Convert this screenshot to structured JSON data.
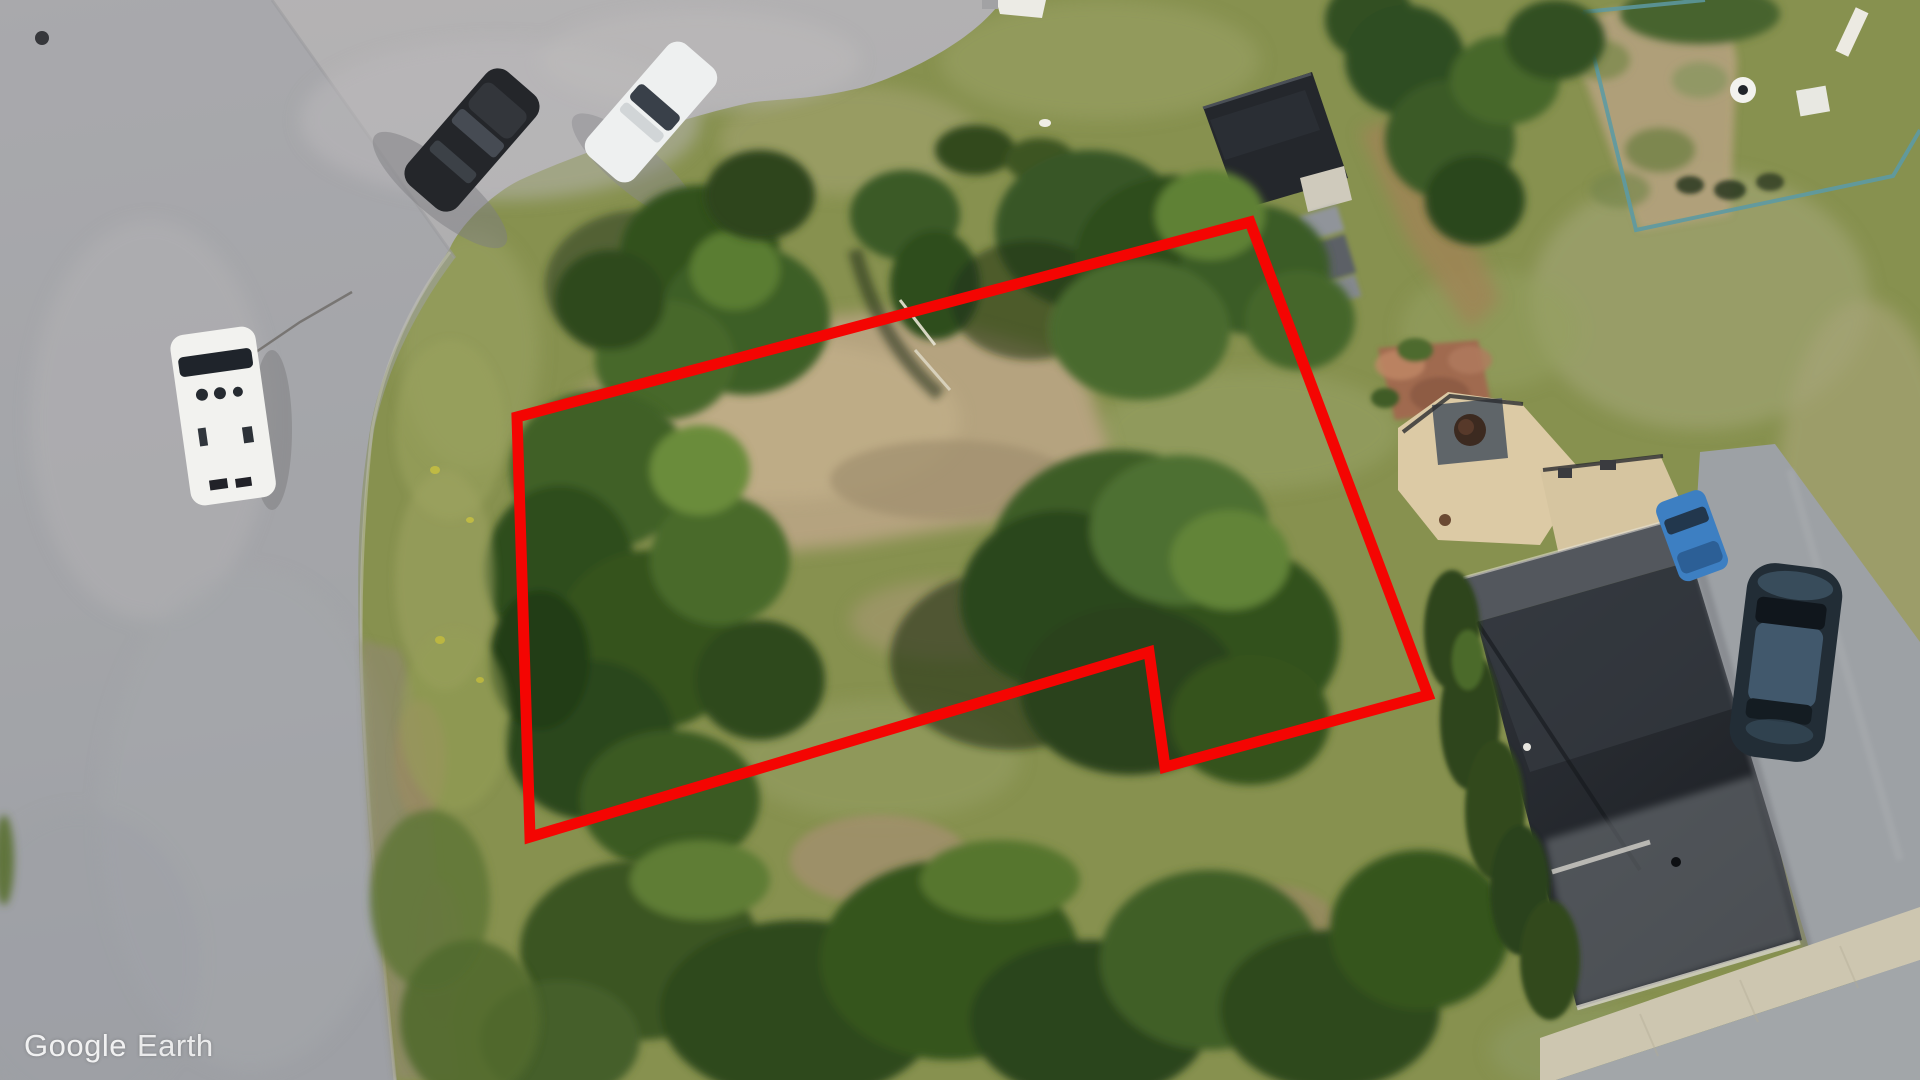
{
  "watermark": {
    "brand": "Google",
    "product": "Earth"
  },
  "annotation": {
    "label": "property-boundary-outline",
    "points": "517,417 1250,222 1428,695 1165,767 1149,652 530,837",
    "color": "#f40502",
    "stroke_width": "11"
  },
  "palette": {
    "grass": "#87914f",
    "dry_grass": "#a3a172",
    "road": "#a9abad",
    "parking_lot": "#b3b1b2",
    "dirt": "#b5a37f",
    "tree_dark": "#2f4a1d",
    "roof_dark": "#24272c",
    "deck_tan": "#dccaa5",
    "fence_teal": "#5d9aa3",
    "sidewalk": "#cdc6b0",
    "driveway": "#9da1a5",
    "gravel_shoulder": "#8e8a68"
  },
  "scene": {
    "view": "satellite-aerial",
    "vehicles": [
      "white-van-on-road",
      "black-car-parking-lot",
      "white-car-parking-lot",
      "blue-car-by-house",
      "dark-sedan-on-driveway"
    ],
    "buildings": [
      "flat-roof-garage",
      "main-house-dark-roof",
      "deck-with-hot-tub"
    ],
    "features": [
      "vacant-lot",
      "dirt-patch",
      "fenced-yard",
      "sidewalk",
      "driveway",
      "tree-clusters"
    ]
  }
}
